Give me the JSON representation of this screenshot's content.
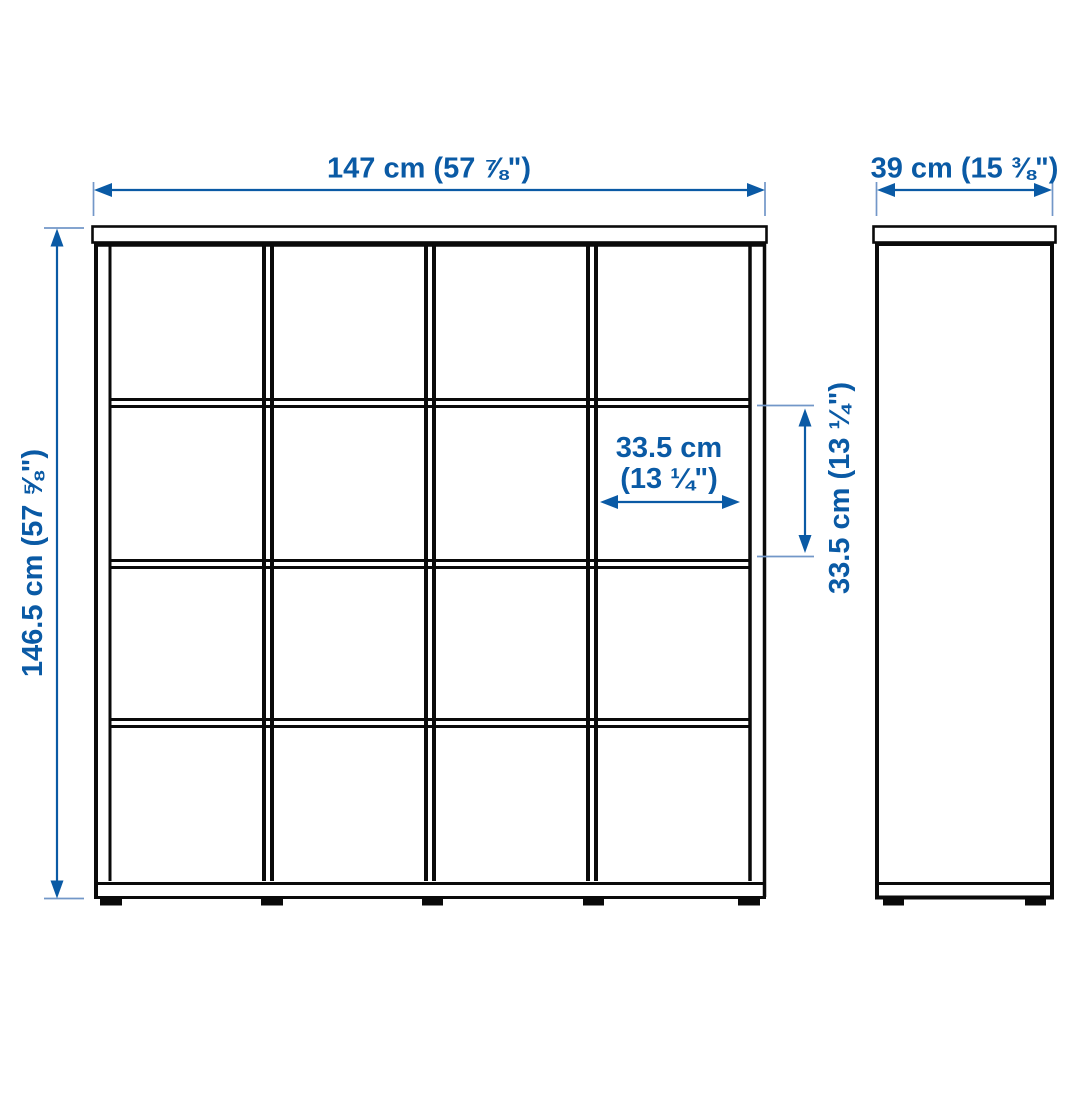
{
  "page": {
    "type": "product-dimension-diagram",
    "background": "#ffffff"
  },
  "palette": {
    "dimension_blue": "#0A5AA5",
    "extension_tick_blue": "#7297C8",
    "outline_black": "#0a0a0a"
  },
  "front_view": {
    "name": "front elevation of cube shelving unit",
    "grid_rows": 4,
    "grid_columns": 4,
    "cell_count": 16,
    "labels": {
      "overall_width": "147 cm (57 ⅞\")",
      "overall_height": "146.5 cm (57 ⅝\")",
      "cell_width": [
        "33.5 cm",
        "(13 ¼\")"
      ],
      "cell_height": "33.5 cm (13 ¼\")"
    }
  },
  "side_view": {
    "name": "side elevation of cube shelving unit",
    "labels": {
      "depth": "39 cm (15 ⅜\")"
    }
  }
}
